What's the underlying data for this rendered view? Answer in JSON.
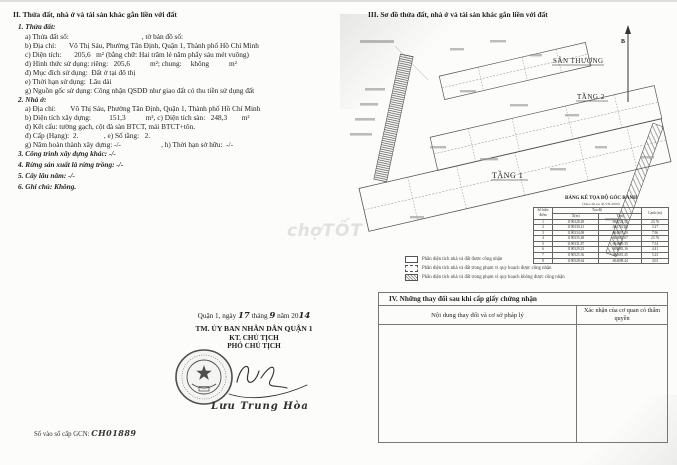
{
  "section_ii": {
    "heading": "II. Thửa đất, nhà ở và tài sản khác gắn liền với đất",
    "parcel_heading": "1. Thửa đất:",
    "parcel": {
      "a": "a) Thửa đất số:                                        , tờ bản đồ số:",
      "b": "b) Địa chỉ:       Võ Thị Sáu, Phường Tân Định, Quận 1, Thành phố Hồ Chí Minh",
      "c": "c) Diện tích:       205,6   m² (bằng chữ: Hai trăm lẻ năm phẩy sáu mét vuông)",
      "d": "d) Hình thức sử dụng: riêng:   205,6           m²; chung:     không           m²",
      "dd": "đ) Mục đích sử dụng:  Đất ở tại đô thị",
      "e": "e) Thời hạn sử dụng:  Lâu dài",
      "g": "g) Nguồn gốc sử dụng: Công nhận QSDĐ như giao đất có thu tiền sử dụng đất"
    },
    "house_heading": "2. Nhà ở:",
    "house": {
      "a": "a) Địa chỉ:        Võ Thị Sáu, Phường Tân Định, Quận 1, Thành phố Hồ Chí Minh",
      "b": "b) Diện tích xây dựng:          151,3           m², c) Diện tích sàn:   248,3        m²",
      "d": "d) Kết cấu: tường gạch, cột đà sàn BTCT, mái BTCT+tôn.",
      "dd": "đ) Cấp (Hạng):  2.              , e) Số tầng:   2.",
      "g": "g) Năm hoàn thành xây dựng: -/-                      , h) Thời hạn sở hữu:  -/-"
    },
    "other_construction": "3. Công trình xây dựng khác: -/-",
    "forest": "4. Rừng sản xuất là rừng trồng: -/-",
    "perennial": "5. Cây lâu năm: -/-",
    "note": "6. Ghi chú: Không."
  },
  "section_iii": {
    "heading": "III. Sơ đồ thửa đất, nhà ở và tài sản khác gắn liền với đất",
    "labels": {
      "north": "B",
      "rooftop": "SÂN THƯỢNG",
      "floor2": "TẦNG 2",
      "floor1": "TẦNG 1"
    },
    "coord_table": {
      "title": "BẢNG KÊ TỌA ĐỘ GÓC RANH",
      "subtitle": "(Theo hệ tọa độ VN-2000)",
      "col_point": "Số hiệu điểm",
      "col_coord": "Tọa độ",
      "col_x": "X(m)",
      "col_y": "Y(m)",
      "col_edge": "Cạnh (m)",
      "rows": [
        {
          "p": "1",
          "x": "1190328.48",
          "y": "604724.55",
          "e": "23.76"
        },
        {
          "p": "2",
          "x": "1190330.41",
          "y": "604701.28",
          "e": "3.27"
        },
        {
          "p": "3",
          "x": "1190334.08",
          "y": "604697.19",
          "e": "7.96"
        },
        {
          "p": "4",
          "x": "1190335.48",
          "y": "604693.67",
          "e": "23.76"
        },
        {
          "p": "5",
          "x": "1190331.87",
          "y": "604699.35",
          "e": "7.54"
        },
        {
          "p": "6",
          "x": "1190329.23",
          "y": "604683.16",
          "e": "4.41"
        },
        {
          "p": "7",
          "x": "1190325.36",
          "y": "604681.45",
          "e": "5.23"
        },
        {
          "p": "8",
          "x": "1190328.64",
          "y": "604698.44",
          "e": "4.03"
        }
      ]
    },
    "legend": [
      {
        "text": "Phần diện tích nhà và đất được công nhận"
      },
      {
        "text": "Phần diện tích nhà và đất trong phạm vi quy hoạch được công nhận"
      },
      {
        "text": "Phần diện tích nhà và đất trong phạm vi quy hoạch không được công nhận"
      }
    ]
  },
  "section_iv": {
    "heading": "IV. Những thay đổi sau khi cấp giấy chứng nhận",
    "col_content": "Nội dung thay đổi và cơ sở pháp lý",
    "col_confirm": "Xác nhận của cơ quan có thẩm quyền"
  },
  "signature": {
    "date_prefix": "Quận 1, ngày",
    "day": "17",
    "month_label": "tháng",
    "month": "9",
    "year_label": "năm 20",
    "year": "14",
    "authority": "TM. ỦY BAN NHÂN DÂN QUẬN 1",
    "title1": "KT. CHỦ TỊCH",
    "title2": "PHÓ CHỦ TỊCH",
    "signer": "Lưu Trung Hòa"
  },
  "footer": {
    "gcn_label": "Số vào sổ cấp GCN: ",
    "gcn_number": "CH01889"
  },
  "watermark": {
    "part1": "chợ",
    "part2": "TỐT"
  }
}
